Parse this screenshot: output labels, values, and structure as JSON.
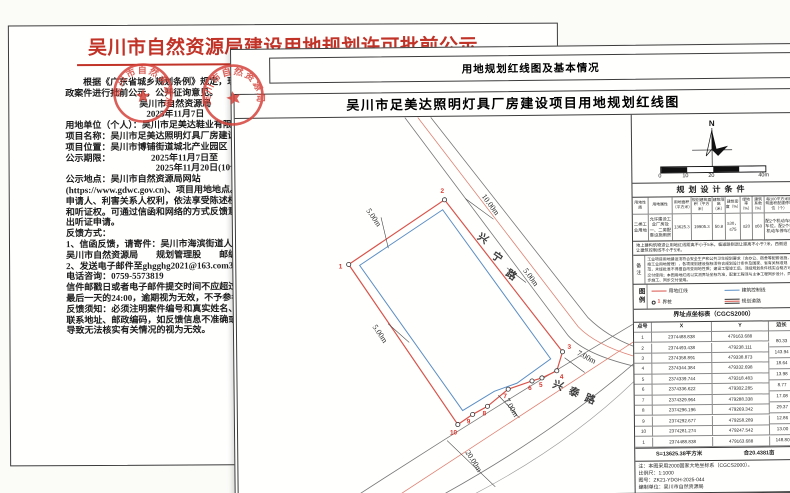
{
  "notice": {
    "title": "吴川市自然资源局建设用地规划许可批前公示",
    "lines": [
      {
        "t": "　　根据《广东省城乡规划条例》规定，现将以下行"
      },
      {
        "t": "政案件进行批前公示，公开征询意见。"
      },
      {
        "t": "吴川市自然资源局",
        "c": "center"
      },
      {
        "t": "2025年11月7日",
        "c": "center"
      },
      {
        "t": "用地单位（个人）：吴川市足美达鞋业有限公司"
      },
      {
        "t": "项目名称：吴川市足美达照明灯具厂房建设项目"
      },
      {
        "t": "项目位置：吴川市博铺街道城北产业园区"
      },
      {
        "t": "公示期限：　　　　　2025年11月7日至"
      },
      {
        "t": "　　　　　　　　　　2025年11月20日(10个工作日)"
      },
      {
        "t": "公示地点：吴川市自然资源局网站"
      },
      {
        "t": "(https://www.gdwc.gov.cn)、项目用地地点。"
      },
      {
        "t": "申请人、利害关系人权利，依法享受陈述权、申辩权"
      },
      {
        "t": "和听证权。可通过信函和网络的方式反馈意见或者提"
      },
      {
        "t": "出听证申请。"
      },
      {
        "t": "反馈方式："
      },
      {
        "t": "1、信函反馈，请寄件：吴川市海滨街道人民东路72号"
      },
      {
        "t": "吴川市自然资源局　　规划管理股　　邮编:524500"
      },
      {
        "t": "2、发送电子邮件至ghgghg2021@163.com3、"
      },
      {
        "t": "电话咨询：0759-5573819"
      },
      {
        "t": "信件邮戳日或者电子邮件提交时间不应超过公示期限"
      },
      {
        "t": "最后一天的24:00，逾期视为无效，不予参考。"
      },
      {
        "t": "反馈须知：必须注明案件编号和真实姓名、联系电话、"
      },
      {
        "t": "联系地址、邮政编码，如反馈信息不准确或不完整，"
      },
      {
        "t": "导致无法核实有关情况的视为无效。"
      }
    ]
  },
  "seal": {
    "text": "吴川市自然资源局"
  },
  "plan": {
    "header": "用地规划红线图及基本情况",
    "map_title": "吴川市足美达照明灯具厂房建设项目用地规划红线图",
    "north_label": "N",
    "scale_labels": [
      "0",
      "10",
      "20",
      "40m"
    ],
    "road1_chars": [
      "兴",
      "宁",
      "路"
    ],
    "road2_chars": [
      "兴",
      "泰",
      "路"
    ],
    "dims": {
      "d1": "5.00m",
      "d2": "10.00m",
      "d3": "5.00m",
      "d4": "5.00m",
      "d5": "7.00m",
      "d6": "7.00m",
      "d7": "20.00m"
    },
    "point_labels": [
      "1",
      "2",
      "3",
      "4",
      "5",
      "6",
      "7",
      "8",
      "9",
      "10"
    ],
    "conditions": {
      "title": "规划设计条件",
      "headers": [
        "用地性质",
        "用地属性",
        "用地面积（平方米）",
        "规划建筑面积（平方米）",
        "建筑限高（米）",
        "建筑密度（%）",
        "绿地率（%）",
        "建筑系数（%）",
        "每100平方米建筑面积配建停车位（个）"
      ],
      "values": [
        "二类工业用地",
        "允许建设工业厂房及一、二类配套设施用房",
        "13625.3",
        "19905.3",
        "50.8",
        "≥30，≤75",
        "≤20",
        "≥60",
        "配2个机动车停车位，配2个非机动车停车位"
      ]
    },
    "setback_note": "地上建构筑物退让用地红线距离不小于5米，临道路侧退让距离不小于7米，西侧退让建筑控制线不小于5米。",
    "remark_label": "备注",
    "remark_text": "工业项目用地建设须符合安全生产和公共卫生规划要求（含办公、宿舍等配套设施，按工业用地管理），各项规划建设指标须符合规划设计条件及国家、省有关标准规范，未经批准不得擅自改变用地性质；建设工程竣工后，须经规划条件核实合格方可交付使用；本图用地红线以实测界址坐标为准，配套工程须与主体工程同步设计、同步施工、同步交付使用。",
    "legend": {
      "label": "图例",
      "items": [
        "用地红线",
        "建筑控制线",
        "界桩",
        "规划道路"
      ],
      "marker_num": "1"
    },
    "coords": {
      "title": "界址点坐标表（CGCS2000）",
      "headers": [
        "点号",
        "X",
        "Y",
        "边长"
      ],
      "rows": [
        [
          "1",
          "2374488.838",
          "479163.688"
        ],
        [
          "2",
          "2374493.438",
          "479238.111"
        ],
        [
          "3",
          "2374358.891",
          "479338.873"
        ],
        [
          "4",
          "2374344.384",
          "479332.698"
        ],
        [
          "5",
          "2374339.744",
          "479318.483"
        ],
        [
          "6",
          "2374336.622",
          "479302.285"
        ],
        [
          "7",
          "2374329.964",
          "479288.338"
        ],
        [
          "8",
          "2374296.196",
          "479269.342"
        ],
        [
          "9",
          "2374292.677",
          "479258.289"
        ],
        [
          "10",
          "2374281.274",
          "479247.542"
        ],
        [
          "1",
          "2374488.838",
          "479163.688"
        ]
      ],
      "lengths": [
        "80.33",
        "143.94",
        "18.64",
        "13.98",
        "8.77",
        "17.08",
        "29.37",
        "12.86",
        "13.00",
        "148.80"
      ]
    },
    "area_summary": {
      "sqm": "S=13625.38平方米",
      "mu": "合20.4381亩"
    },
    "notes": [
      "注：本图采用2000国家大地坐标系（CGCS2000）。",
      "比例尺：1:1000",
      "图号：ZK21-YDGH-2025-044",
      "编制单位：吴川市自然资源局"
    ]
  }
}
